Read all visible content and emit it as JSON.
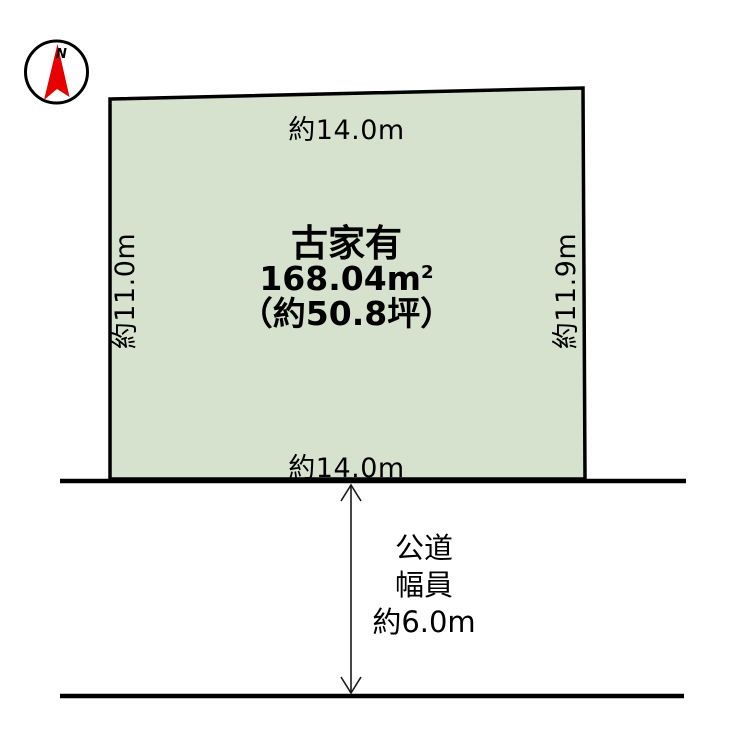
{
  "compass": {
    "north_label": "N"
  },
  "plot": {
    "top_dimension": "約14.0m",
    "bottom_dimension": "約14.0m",
    "left_dimension": "約11.0m",
    "right_dimension": "約11.9m",
    "building_note": "古家有",
    "area_m2_value": "168.04m",
    "area_m2_sup": "2",
    "area_tsubo": "（約50.8坪）"
  },
  "road": {
    "type_label": "公道",
    "width_label": "幅員",
    "width_value": "約6.0m"
  },
  "colors": {
    "plot_fill": "#d6e2cd",
    "plot_border": "#000000",
    "road_line": "#000000",
    "arrow": "#1a1a1a",
    "compass_needle": "#e60000",
    "compass_ring": "#000000"
  }
}
